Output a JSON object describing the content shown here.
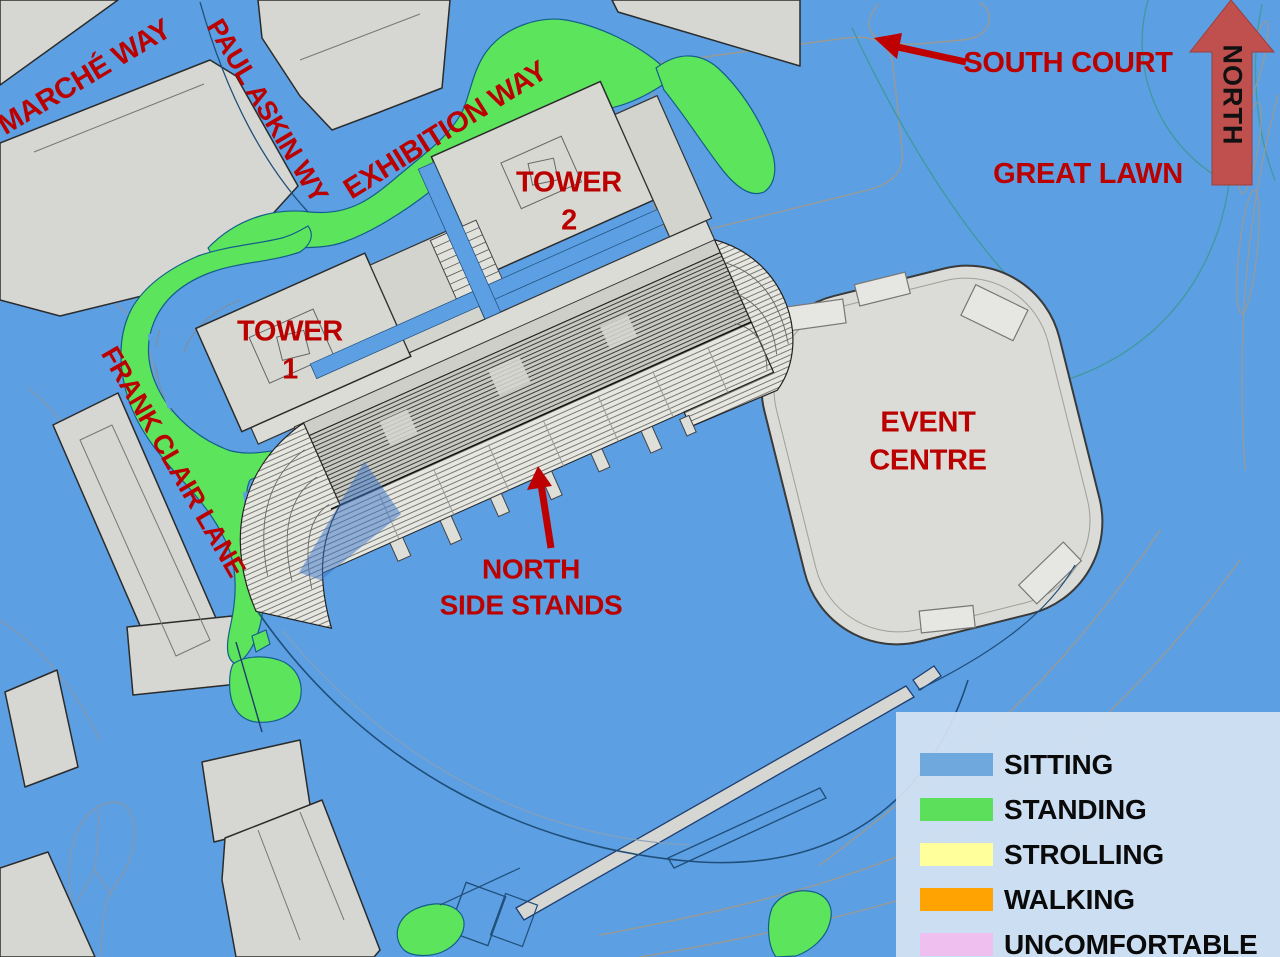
{
  "map": {
    "streets": {
      "marche_way": "MARCHÉ WAY",
      "paul_askin_wy": "PAUL ASKIN WY",
      "exhibition_way": "EXHIBITION WAY",
      "frank_clair_lane": "FRANK CLAIR LANE"
    },
    "places": {
      "tower1_line1": "TOWER",
      "tower1_line2": "1",
      "tower2_line1": "TOWER",
      "tower2_line2": "2",
      "event_centre_line1": "EVENT",
      "event_centre_line2": "CENTRE",
      "south_court": "SOUTH COURT",
      "great_lawn": "GREAT LAWN",
      "north_stands_line1": "NORTH",
      "north_stands_line2": "SIDE STANDS"
    },
    "compass": {
      "label": "NORTH"
    }
  },
  "legend": {
    "items": [
      {
        "label": "SITTING",
        "color": "#6FA8DC"
      },
      {
        "label": "STANDING",
        "color": "#5CE05C"
      },
      {
        "label": "STROLLING",
        "color": "#FFFF9C"
      },
      {
        "label": "WALKING",
        "color": "#FFA303"
      },
      {
        "label": "UNCOMFORTABLE",
        "color": "#EFC0EF"
      }
    ]
  },
  "colors": {
    "sitting_blue": "#5C9FE3",
    "standing_green": "#5CE55C",
    "building_gray": "#D6D6D2",
    "label_red": "#BB0000",
    "north_arrow_red": "#C0504D",
    "legend_bg": "#D5E3F3"
  }
}
